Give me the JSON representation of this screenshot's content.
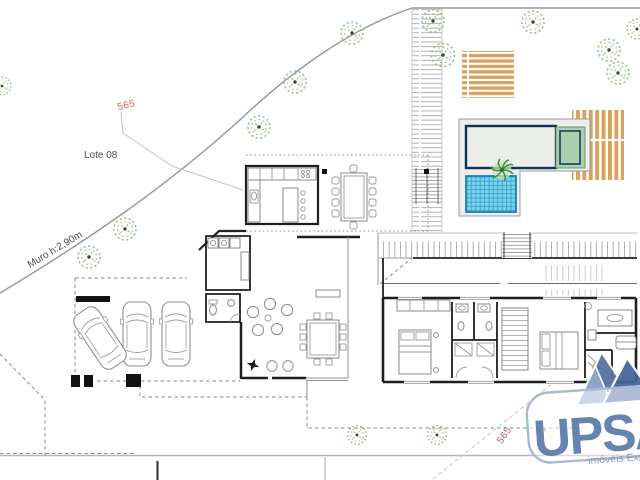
{
  "labels": {
    "lot": "Lote 08",
    "street_number_top": "565",
    "street_number_bottom": "565",
    "wall_note": "Muro h:2,90m"
  },
  "watermark": {
    "brand": "UPSA",
    "tagline": "imóveis Exp",
    "brand_color": "#5b7bab",
    "tagline_color": "#7d91b4",
    "border_color": "#a3b4d2"
  },
  "colors": {
    "pool_main": "#3e74b4",
    "pool_grid": "#26538e",
    "pool_border": "#0f3258",
    "kids_pool": "#7cd2ee",
    "kids_grid": "#38a3cc",
    "spa_surround": "#a9cfad",
    "deck_wood": "#d7a15e",
    "tree_green": "#9dc08b",
    "street_red": "#c4635c",
    "wall_black": "#1f1f1f"
  },
  "site": {
    "trees": [
      {
        "x": 352,
        "y": 33,
        "s": 1.0
      },
      {
        "x": 433,
        "y": 21,
        "s": 1.0
      },
      {
        "x": 533,
        "y": 22,
        "s": 1.0
      },
      {
        "x": 443,
        "y": 55,
        "s": 1.05
      },
      {
        "x": 609,
        "y": 50,
        "s": 1.0
      },
      {
        "x": 618,
        "y": 73,
        "s": 1.0
      },
      {
        "x": 637,
        "y": 29,
        "s": 0.9
      },
      {
        "x": 295,
        "y": 82,
        "s": 1.0
      },
      {
        "x": 259,
        "y": 127,
        "s": 1.0
      },
      {
        "x": 125,
        "y": 229,
        "s": 1.0
      },
      {
        "x": 89,
        "y": 257,
        "s": 1.0
      },
      {
        "x": 2,
        "y": 86,
        "s": 0.8
      },
      {
        "x": 357,
        "y": 435,
        "s": 0.85
      },
      {
        "x": 437,
        "y": 435,
        "s": 0.85
      },
      {
        "x": 545,
        "y": 430,
        "s": 0.8,
        "faint": true
      }
    ],
    "cars": [
      {
        "x": 123,
        "y": 302,
        "rot": 0
      },
      {
        "x": 162,
        "y": 302,
        "rot": 0
      },
      {
        "x": 86,
        "y": 306,
        "rot": -34
      }
    ]
  }
}
